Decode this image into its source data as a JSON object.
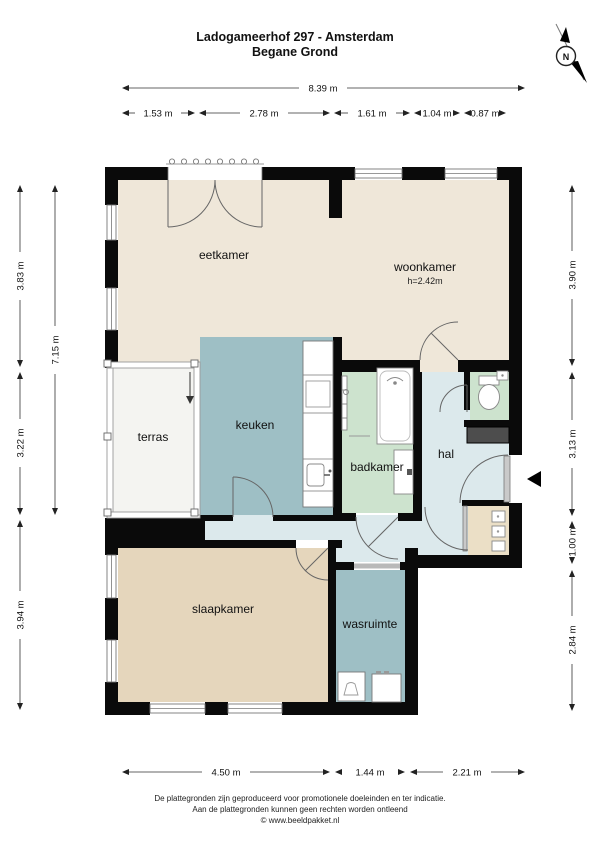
{
  "header": {
    "title_line1": "Ladogameerhof 297 - Amsterdam",
    "title_line2": "Begane Grond"
  },
  "compass": {
    "label": "N"
  },
  "rooms": {
    "eetkamer": {
      "label": "eetkamer"
    },
    "woonkamer": {
      "label": "woonkamer",
      "height_note": "h=2.42m"
    },
    "terras": {
      "label": "terras"
    },
    "keuken": {
      "label": "keuken"
    },
    "badkamer": {
      "label": "badkamer"
    },
    "hal": {
      "label": "hal"
    },
    "slaapkamer": {
      "label": "slaapkamer"
    },
    "wasruimte": {
      "label": "wasruimte"
    }
  },
  "dimensions": {
    "top_total": "8.39 m",
    "top_segments": [
      "1.53 m",
      "2.78 m",
      "1.61 m",
      "1.04 m",
      "0.87 m"
    ],
    "left_total": "7.15 m",
    "left_segments": [
      "3.83 m",
      "3.22 m",
      "3.94 m"
    ],
    "right_segments": [
      "3.90 m",
      "3.13 m",
      "1.00 m",
      "2.84 m"
    ],
    "bottom_segments": [
      "4.50 m",
      "1.44 m",
      "2.21 m"
    ]
  },
  "footer": {
    "line1": "De plattegronden zijn geproduceerd voor promotionele doeleinden en ter indicatie.",
    "line2": "Aan de plattegronden kunnen geen rechten worden ontleend",
    "line3": "© www.beeldpakket.nl"
  },
  "colors": {
    "walls": "#0a0a0a",
    "living_area": "#EFE7D9",
    "bedroom": "#E5D6BC",
    "closet": "#EBDFC6",
    "kitchen_laundry": "#9EBFC5",
    "bathroom_toilet": "#CDE3CE",
    "hall": "#DCE9EC",
    "terrace": "#F4F4F1",
    "cabinet_dark": "#4D4D4D"
  }
}
